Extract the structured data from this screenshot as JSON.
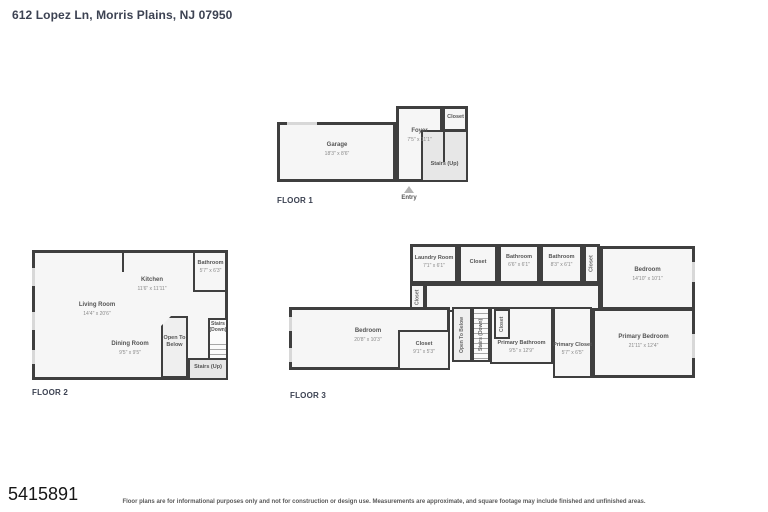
{
  "title": "612 Lopez Ln, Morris Plains, NJ 07950",
  "watermark": "5415891",
  "disclaimer": "Floor plans are for informational purposes only and not for construction or design use. Measurements are approximate, and square footage may include finished and unfinished areas.",
  "colors": {
    "wall": "#3f3f3f",
    "room_fill": "#f6f6f6",
    "shaded_fill": "#e7e7e7",
    "title_text": "#3c4252",
    "label_text": "#555555"
  },
  "f1": {
    "label": "FLOOR 1",
    "entry": "Entry",
    "garage": {
      "name": "Garage",
      "dims": "18'3\" x 8'6\""
    },
    "foyer": {
      "name": "Foyer",
      "dims": "7'5\" x 11'1\""
    },
    "closet": {
      "name": "Closet"
    },
    "stairs_up": {
      "name": "Stairs (Up)"
    }
  },
  "f2": {
    "label": "FLOOR 2",
    "living": {
      "name": "Living Room",
      "dims": "14'4\" x 20'6\""
    },
    "kitchen": {
      "name": "Kitchen",
      "dims": "11'6\" x 11'11\""
    },
    "bathroom": {
      "name": "Bathroom",
      "dims": "5'7\" x 6'3\""
    },
    "dining": {
      "name": "Dining Room",
      "dims": "9'5\" x 9'5\""
    },
    "open_below": {
      "name": "Open To Below"
    },
    "stairs_down": {
      "name": "Stairs (Down)"
    },
    "stairs_up": {
      "name": "Stairs (Up)"
    }
  },
  "f3": {
    "label": "FLOOR 3",
    "laundry": {
      "name": "Laundry Room",
      "dims": "7'1\" x 6'1\""
    },
    "closet_top": {
      "name": "Closet"
    },
    "bathroom_a": {
      "name": "Bathroom",
      "dims": "6'6\" x 6'1\""
    },
    "bathroom_b": {
      "name": "Bathroom",
      "dims": "8'3\" x 6'1\""
    },
    "closet_mid": {
      "name": "Closet"
    },
    "bedroom_top": {
      "name": "Bedroom",
      "dims": "14'10\" x 10'1\""
    },
    "closet_left": {
      "name": "Closet"
    },
    "bedroom_left": {
      "name": "Bedroom",
      "dims": "20'8\" x 10'3\""
    },
    "closet_br": {
      "name": "Closet",
      "dims": "9'1\" x 5'3\""
    },
    "open_below": {
      "name": "Open To Below"
    },
    "stairs_down": {
      "name": "Stairs (Down)"
    },
    "closet_small": {
      "name": "Closet"
    },
    "primary_bath": {
      "name": "Primary Bathroom",
      "dims": "9'5\" x 12'9\""
    },
    "primary_closet": {
      "name": "Primary Closet",
      "dims": "5'7\" x 6'5\""
    },
    "primary_bedroom": {
      "name": "Primary Bedroom",
      "dims": "21'11\" x 12'4\""
    }
  }
}
